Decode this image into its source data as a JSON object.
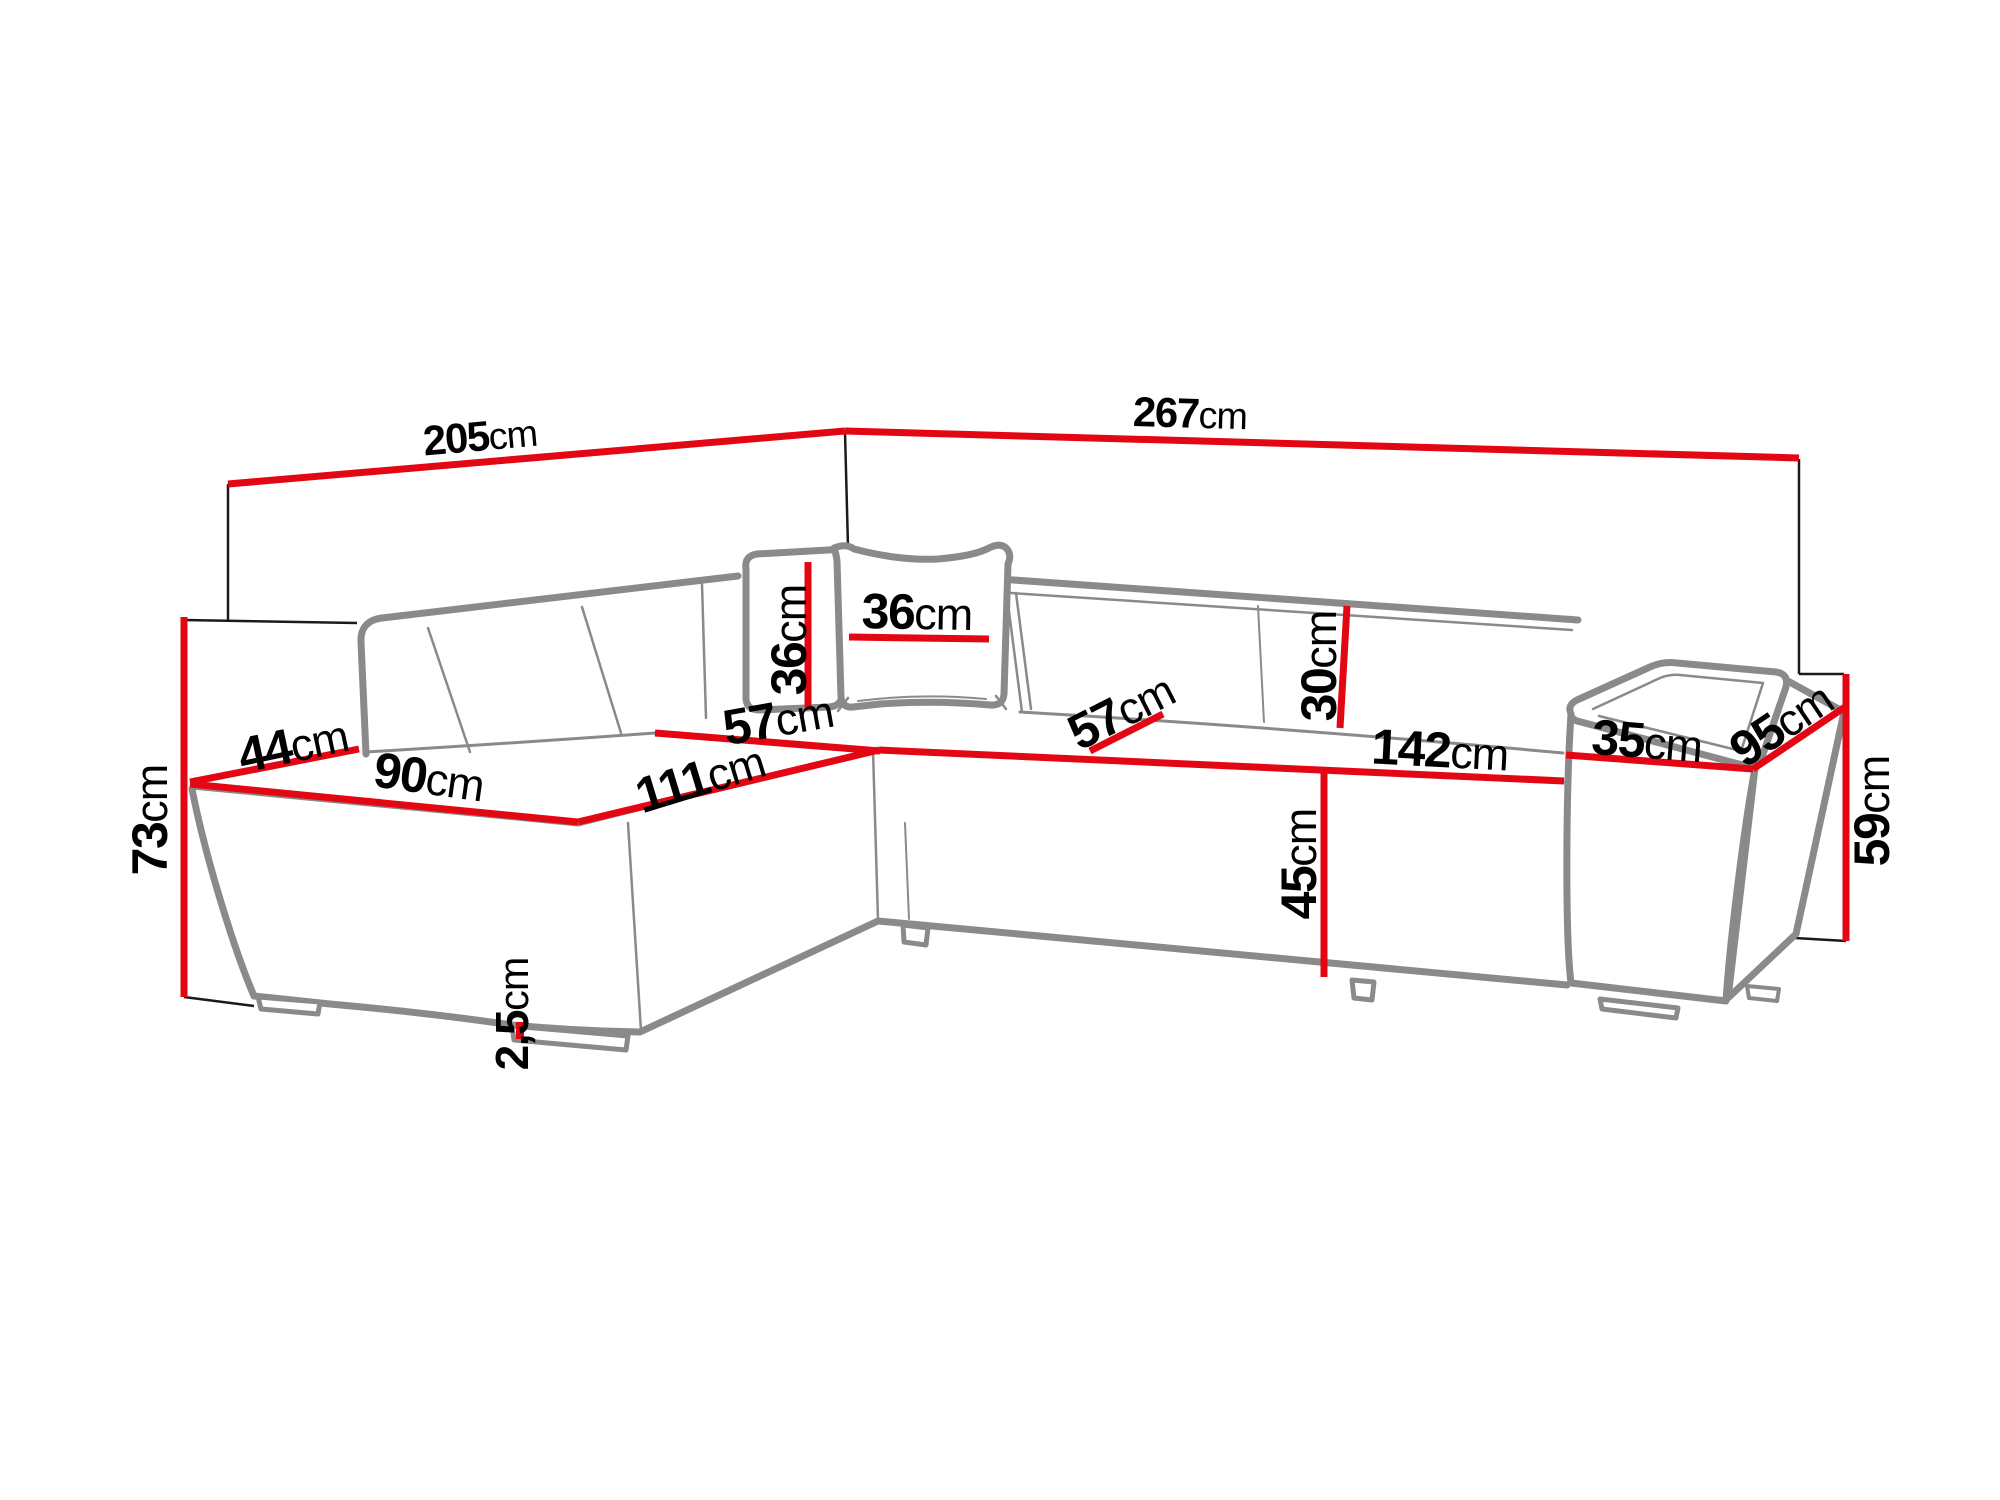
{
  "figure": {
    "title": "Corner sofa dimension diagram",
    "type": "furniture-dimension-diagram",
    "unit": "cm",
    "colors": {
      "dimension_line": "#e30613",
      "sofa_outline": "#8a8a8a",
      "reference_line": "#1a1a1a",
      "background": "#ffffff",
      "text": "#000000"
    }
  },
  "dimensions": [
    {
      "id": "back-width-left",
      "value": "205",
      "unit": "cm"
    },
    {
      "id": "back-width-right",
      "value": "267",
      "unit": "cm"
    },
    {
      "id": "total-height",
      "value": "73",
      "unit": "cm"
    },
    {
      "id": "left-backrest-depth",
      "value": "44",
      "unit": "cm"
    },
    {
      "id": "chaise-width",
      "value": "90",
      "unit": "cm"
    },
    {
      "id": "chaise-length",
      "value": "111",
      "unit": "cm"
    },
    {
      "id": "corner-seat-depth",
      "value": "57",
      "unit": "cm"
    },
    {
      "id": "pillow-height",
      "value": "36",
      "unit": "cm"
    },
    {
      "id": "pillow-width",
      "value": "36",
      "unit": "cm"
    },
    {
      "id": "seat-depth",
      "value": "57",
      "unit": "cm"
    },
    {
      "id": "backrest-height",
      "value": "30",
      "unit": "cm"
    },
    {
      "id": "seat-width",
      "value": "142",
      "unit": "cm"
    },
    {
      "id": "seat-front-height",
      "value": "45",
      "unit": "cm"
    },
    {
      "id": "armrest-width",
      "value": "35",
      "unit": "cm"
    },
    {
      "id": "armrest-length",
      "value": "95",
      "unit": "cm"
    },
    {
      "id": "armrest-height",
      "value": "59",
      "unit": "cm"
    },
    {
      "id": "leg-height",
      "value": "2,5",
      "unit": "cm"
    }
  ]
}
